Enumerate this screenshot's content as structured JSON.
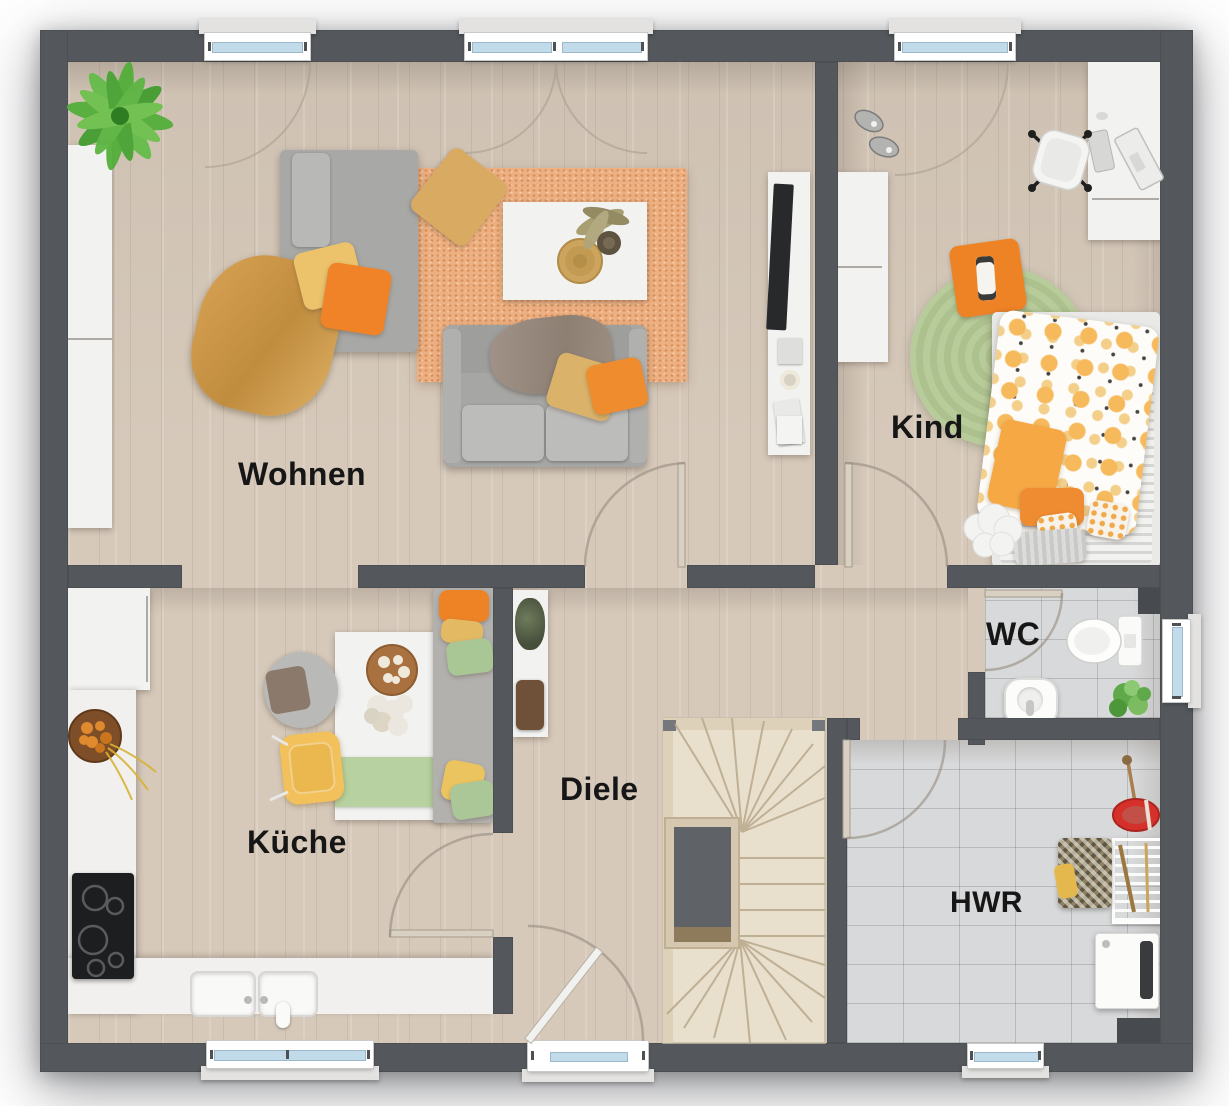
{
  "plan": {
    "type": "floor-plan",
    "rooms": [
      {
        "id": "wohnen",
        "label": "Wohnen",
        "floor": "wood"
      },
      {
        "id": "kind",
        "label": "Kind",
        "floor": "wood"
      },
      {
        "id": "kueche",
        "label": "Küche",
        "floor": "wood"
      },
      {
        "id": "diele",
        "label": "Diele",
        "floor": "wood"
      },
      {
        "id": "wc",
        "label": "WC",
        "floor": "tile"
      },
      {
        "id": "hwr",
        "label": "HWR",
        "floor": "tile"
      }
    ],
    "palette": {
      "wall": "#54585c",
      "wood_floor": "#d6c9ba",
      "tile_floor": "#d8d9da",
      "stair_wood": "#e8dfcd",
      "rug_orange": "#edb082",
      "rug_green": "#b5c897",
      "window_glass": "#c2dbeb",
      "accent_orange": "#ef8b2e",
      "accent_yellow": "#e8c06a",
      "accent_green": "#aac697",
      "furniture_white": "#f2f2f1",
      "sofa_gray": "#a7a7a5",
      "bucket_red": "#d6302a"
    }
  }
}
